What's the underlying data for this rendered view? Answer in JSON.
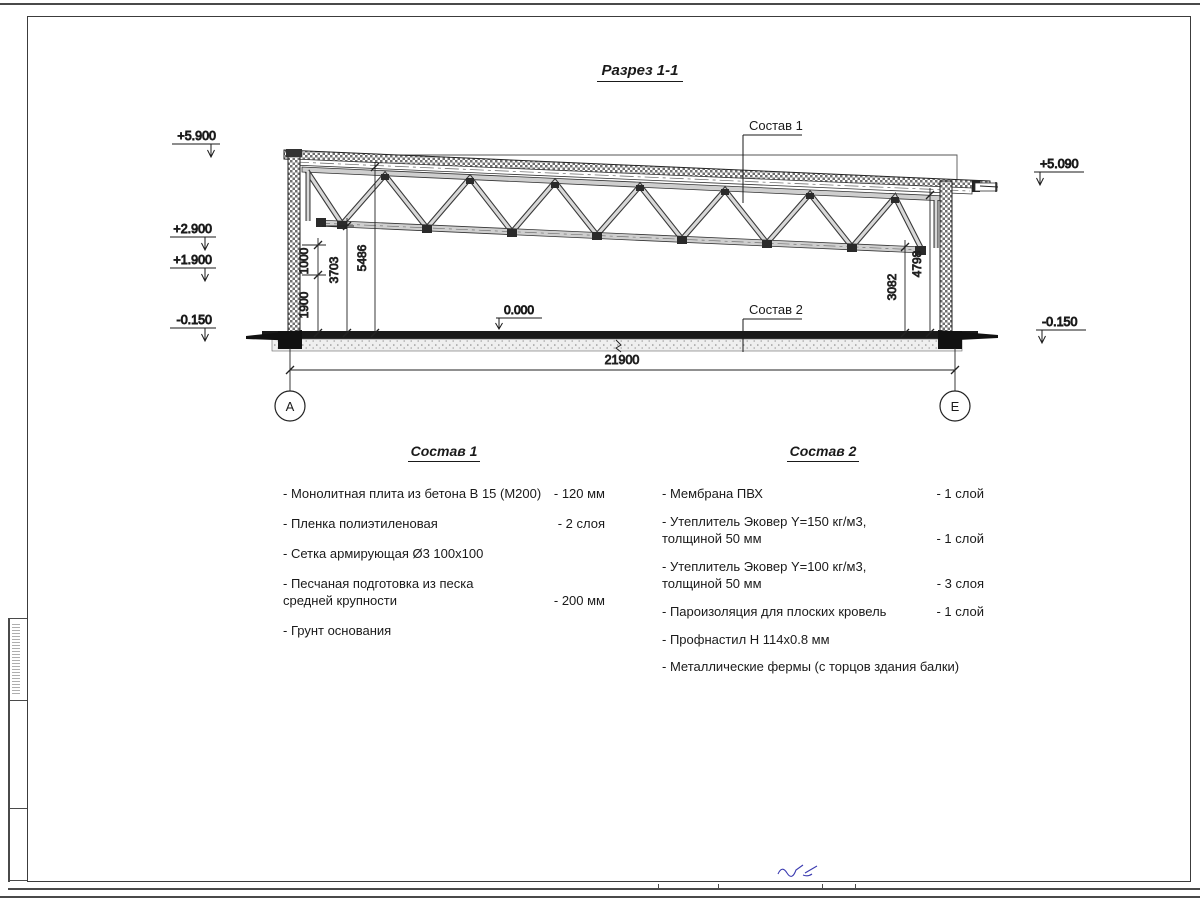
{
  "title": "Разрез 1-1",
  "section": {
    "label_sostav1": "Состав 1",
    "label_sostav2": "Состав 2",
    "floor_level": "0.000",
    "elevations": {
      "left": [
        "+5.900",
        "+2.900",
        "+1.900",
        "-0.150"
      ],
      "right": [
        "+5.090",
        "-0.150"
      ]
    },
    "dimensions": {
      "d1000": "1000",
      "d1900": "1900",
      "d3703": "3703",
      "d5486": "5486",
      "d3082": "3082",
      "d4798": "4798",
      "span": "21900"
    },
    "axes": {
      "left": "А",
      "right": "Е"
    }
  },
  "sostav1": {
    "heading": "Состав 1",
    "items": [
      {
        "name": "- Монолитная плита из бетона В 15 (М200)",
        "value": "- 120 мм"
      },
      {
        "name": "- Пленка полиэтиленовая",
        "value": "- 2 слоя"
      },
      {
        "name": "- Сетка армирующая Ø3 100х100",
        "value": ""
      },
      {
        "name": "- Песчаная подготовка из песка\nсредней крупности",
        "value": "- 200 мм"
      },
      {
        "name": "- Грунт основания",
        "value": ""
      }
    ]
  },
  "sostav2": {
    "heading": "Состав 2",
    "items": [
      {
        "name": "- Мембрана ПВХ",
        "value": "- 1 слой"
      },
      {
        "name": "- Утеплитель Эковер Y=150 кг/м3,\nтолщиной 50 мм",
        "value": "- 1 слой"
      },
      {
        "name": "- Утеплитель Эковер Y=100 кг/м3,\nтолщиной 50 мм",
        "value": "- 3 слоя"
      },
      {
        "name": "- Пароизоляция для плоских кровель",
        "value": "- 1 слой"
      },
      {
        "name": "- Профнастил Н 114х0.8 мм",
        "value": ""
      },
      {
        "name": "- Металлические фермы (с торцов здания балки)",
        "value": ""
      }
    ]
  }
}
